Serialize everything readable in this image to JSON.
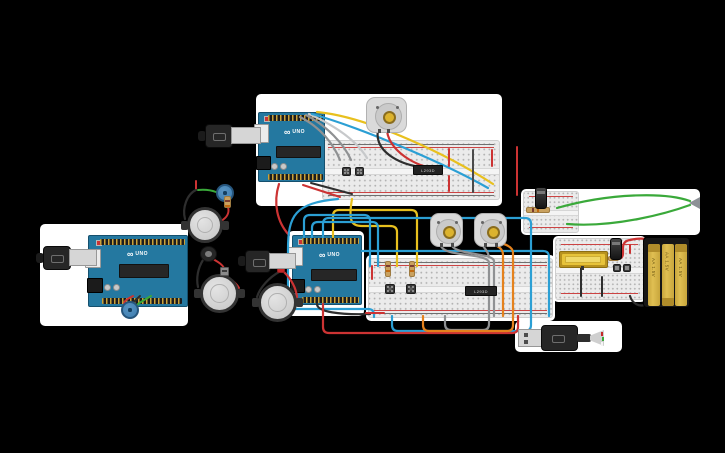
{
  "scene": {
    "background": "#000000",
    "panel": "#ffffff"
  },
  "text": {
    "arduino_logo": "∞",
    "arduino_model": "UNO",
    "battery_cell_label": "AA 1.5V",
    "motor_driver_ic_label": "L293D"
  },
  "colors": {
    "panel": "#ffffff",
    "arduino_board": "#2478a0",
    "motor_body": "#dadada",
    "motor_shaft": "#dcb32e",
    "battery_cell": "#e0bf52",
    "battery_cap": "#b08c2a",
    "potentiometer": "#3c7cb0",
    "wire_red": "#cc3333",
    "wire_black": "#2e2e2e",
    "wire_yellow": "#e8c01e",
    "wire_cyan": "#2b9fd4",
    "wire_gray": "#8f9193",
    "wire_light_gray": "#c7c9cb",
    "wire_orange": "#e5821d",
    "wire_green": "#3aa93a",
    "wire_dark": "#4a4a4a"
  },
  "inventory": {
    "arduino_uno": 3,
    "breadboard": 2,
    "breadboard_mini": 2,
    "hobby_gearmotor": 3,
    "speaker": 3,
    "piezo": 1,
    "potentiometer": 2,
    "pushbutton": 6,
    "motor_driver_ic": 2,
    "resistor": 5,
    "electrolytic_capacitor": 2,
    "battery_pack_3xAA": 1,
    "usb_cable": 4,
    "led": 1,
    "diode": 1,
    "lcd_module": 1
  },
  "wires": [
    {
      "name": "gray-a1",
      "color": "wire_gray",
      "d": "M300,117 C320,127 333,143 340,160"
    },
    {
      "name": "gray-a2",
      "color": "wire_gray",
      "d": "M306,115 C327,126 344,144 351,160"
    },
    {
      "name": "lightgray-a",
      "color": "wire_light_gray",
      "d": "M309,114 C340,128 358,143 367,158"
    },
    {
      "name": "cyan-a",
      "color": "wire_cyan",
      "d": "M312,114 C362,128 446,164 488,188"
    },
    {
      "name": "yellow-a",
      "color": "wire_yellow",
      "d": "M317,112 C370,117 450,156 493,184"
    },
    {
      "name": "black-motor-a",
      "color": "wire_black",
      "d": "M378,130 C374,152 400,164 420,167"
    },
    {
      "name": "red-motor-a",
      "color": "wire_red",
      "d": "M387,131 C390,155 426,170 434,167"
    },
    {
      "name": "red-jumper-a1",
      "color": "wire_red",
      "d": "M449,149 L449,166",
      "w": 2
    },
    {
      "name": "red-jumper-a2",
      "color": "wire_red",
      "d": "M449,176 L449,191",
      "w": 2
    },
    {
      "name": "dark-jumper-a",
      "color": "wire_dark",
      "d": "M473,150 L473,192",
      "w": 2
    },
    {
      "name": "red-jumper-a3",
      "color": "wire_red",
      "d": "M492,150 L492,166",
      "w": 2
    },
    {
      "name": "red-jumper-a4",
      "color": "wire_red",
      "d": "M517,147 L517,195",
      "w": 2
    },
    {
      "name": "red-a-bottom",
      "color": "wire_red",
      "d": "M303,185 L340,197",
      "w": 2
    },
    {
      "name": "black-a-bottom",
      "color": "wire_black",
      "d": "M311,183 L352,194",
      "w": 2
    },
    {
      "name": "red-a-to-b",
      "color": "wire_red",
      "d": "M279,184 C273,203 277,222 289,235"
    },
    {
      "name": "yellow-loop-1",
      "color": "wire_yellow",
      "d": "M333,237 L333,216 Q333,210 339,210 L411,210 Q417,210 417,216 L417,266"
    },
    {
      "name": "yellow-loop-2",
      "color": "wire_yellow",
      "d": "M352,199 C348,222 352,226 362,226 L390,226 Q397,226 397,232 L397,266"
    },
    {
      "name": "cyan-loop-1",
      "color": "wire_cyan",
      "d": "M370,266 L370,221 Q370,215 364,215 L310,215 Q304,215 304,221 L304,237"
    },
    {
      "name": "cyan-loop-2",
      "color": "wire_cyan",
      "d": "M378,266 L378,228 Q378,222 372,222 L318,222 Q312,222 312,228 L312,237"
    },
    {
      "name": "cyan-loop-3",
      "color": "wire_cyan",
      "d": "M323,237 L323,224 Q323,218 329,218 L525,218 Q531,218 531,224 L531,325 Q531,331 525,331 L398,331 Q392,331 392,325 L392,316"
    },
    {
      "name": "cyan-loop-4",
      "color": "wire_cyan",
      "d": "M338,199 C295,203 288,215 288,250 L288,301 Q288,309 296,309 L368,309 Q374,309 374,315 L374,317"
    },
    {
      "name": "cyan-long",
      "color": "wire_cyan",
      "d": "M362,251 L543,251 Q549,251 549,257 L549,316"
    },
    {
      "name": "black-b",
      "color": "wire_black",
      "d": "M317,304 C317,312 340,315 370,314"
    },
    {
      "name": "red-b",
      "color": "wire_red",
      "d": "M323,304 L323,327 Q323,333 329,333 L512,333 Q518,333 518,327 L518,316"
    },
    {
      "name": "red-jumper-b1",
      "color": "wire_red",
      "d": "M372,266 L372,279",
      "w": 2
    },
    {
      "name": "red-jumper-b2",
      "color": "wire_red",
      "d": "M366,313 L384,313",
      "w": 2
    },
    {
      "name": "gray-m1a",
      "color": "wire_gray",
      "d": "M441,246 C445,257 486,253 489,262 L489,324 Q489,330 483,330 L451,330 Q445,330 445,324 L445,316"
    },
    {
      "name": "gray-m1b",
      "color": "wire_gray",
      "d": "M452,246 C458,255 493,253 494,261 L494,316"
    },
    {
      "name": "gray-m2",
      "color": "wire_gray",
      "d": "M483,246 C486,250 488,252 489,257"
    },
    {
      "name": "orange-m2a",
      "color": "wire_orange",
      "d": "M497,246 Q503,249 503,255 L503,316"
    },
    {
      "name": "orange-m2b",
      "color": "wire_orange",
      "d": "M500,243 Q513,246 513,253 L513,325 Q513,331 507,331 L429,331 Q423,331 423,325 L423,316"
    },
    {
      "name": "red-c1",
      "color": "wire_red",
      "d": "M607,259 L617,259 Q623,259 623,253 L623,248 Q623,241 630,240 C638,238 646,238 650,241 Q653,243 653,247"
    },
    {
      "name": "red-c2",
      "color": "wire_red",
      "d": "M630,245 L630,253",
      "w": 2
    },
    {
      "name": "black-c1",
      "color": "wire_black",
      "d": "M581,267 L581,296",
      "w": 2
    },
    {
      "name": "black-c2",
      "color": "wire_black",
      "d": "M602,277 L602,296",
      "w": 2
    },
    {
      "name": "black-battery",
      "color": "wire_black",
      "d": "M648,303 C640,309 632,303 630,296"
    },
    {
      "name": "green-d1",
      "color": "wire_green",
      "d": "M557,208 C610,193 665,192 690,201"
    },
    {
      "name": "green-d2",
      "color": "wire_green",
      "d": "M567,224 C615,228 668,213 690,205"
    },
    {
      "name": "red-pot-c",
      "color": "wire_red",
      "d": "M133,296 C127,299 124,301 124,304",
      "w": 2
    },
    {
      "name": "black-pot-c",
      "color": "wire_black",
      "d": "M140,296 C137,299 134,301 132,304",
      "w": 2
    },
    {
      "name": "green-pot-c",
      "color": "wire_green",
      "d": "M151,296 C146,299 140,302 137,305",
      "w": 2
    },
    {
      "name": "red-s1-stub",
      "color": "wire_red",
      "d": "M196,181 L196,189",
      "w": 2
    },
    {
      "name": "black-s1",
      "color": "wire_black",
      "d": "M196,190 C187,194 182,208 185,219"
    },
    {
      "name": "green-s1",
      "color": "wire_green",
      "d": "M198,190 Q208,189 216,192",
      "w": 2
    },
    {
      "name": "red-s1",
      "color": "wire_red",
      "d": "M228,207 C230,214 226,218 221,221",
      "w": 2
    },
    {
      "name": "black-s2",
      "color": "wire_black",
      "d": "M203,260 C198,268 196,278 198,287"
    },
    {
      "name": "red-s2a",
      "color": "wire_red",
      "d": "M213,259 C218,262 222,264 224,268",
      "w": 2
    },
    {
      "name": "red-s2b",
      "color": "wire_red",
      "d": "M226,276 C232,280 237,284 239,288",
      "w": 2
    },
    {
      "name": "black-s3",
      "color": "wire_black",
      "d": "M279,272 C270,277 260,287 257,297"
    },
    {
      "name": "red-s3",
      "color": "wire_red",
      "d": "M284,272 C291,279 296,288 297,297"
    }
  ]
}
